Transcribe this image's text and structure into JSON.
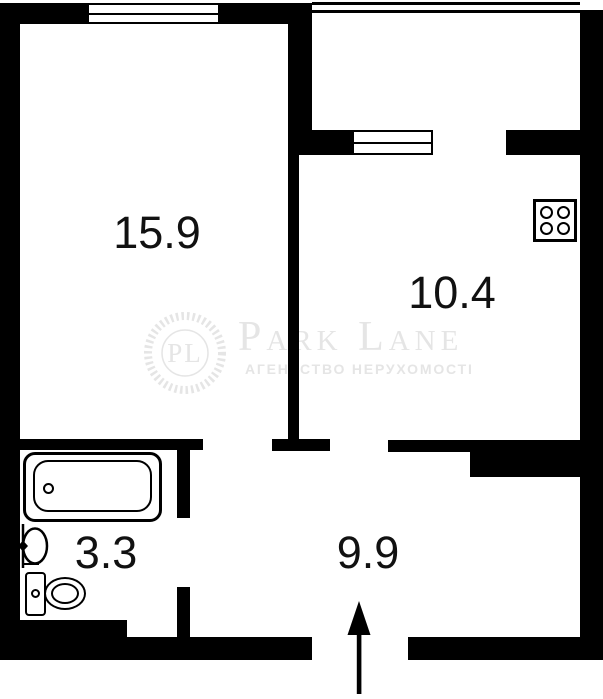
{
  "rooms": {
    "living": {
      "area": "15.9"
    },
    "kitchen": {
      "area": "10.4"
    },
    "bathroom": {
      "area": "3.3"
    },
    "hallway": {
      "area": "9.9"
    }
  },
  "watermark": {
    "monogram": "PL",
    "brand": "Park Lane",
    "tagline": "АГЕНТСТВО НЕРУХОМОСТІ"
  },
  "fixtures": {
    "bathtub": "bathtub-icon",
    "sink": "sink-icon",
    "toilet": "toilet-icon",
    "stove": "stove-icon",
    "entrance": "entrance-arrow-icon"
  },
  "colors": {
    "wall": "#000000",
    "background": "#ffffff",
    "watermark": "#e5e5e5",
    "label": "#111111"
  }
}
